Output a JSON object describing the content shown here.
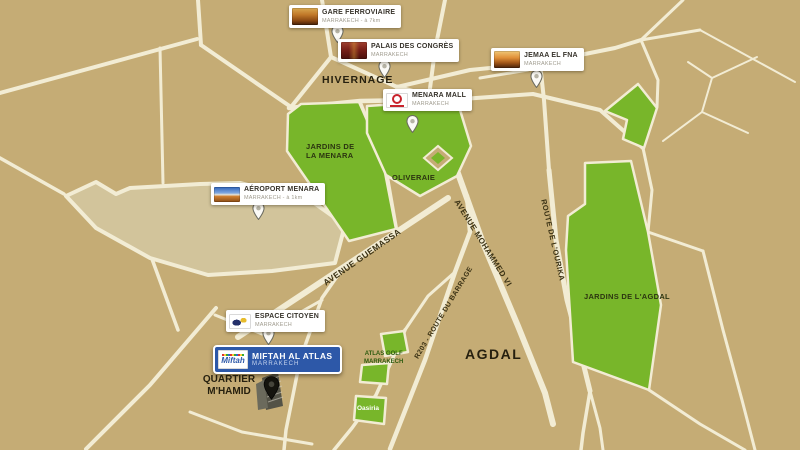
{
  "map": {
    "title": "Plan de situation Miftah Al Atlas - Marrakech",
    "markers": {
      "gare": {
        "title": "GARE FERROVIAIRE",
        "subtitle": "MARRAKECH - à 7km"
      },
      "palais": {
        "title": "PALAIS DES CONGRÈS",
        "subtitle": "MARRAKECH"
      },
      "jemaa": {
        "title": "JEMAA EL FNA",
        "subtitle": "MARRAKECH"
      },
      "menara_mall": {
        "title": "MENARA MALL",
        "subtitle": "MARRAKECH"
      },
      "aeroport": {
        "title": "AÉROPORT MENARA",
        "subtitle": "MARRAKECH - à 1km"
      },
      "espace": {
        "title": "ESPACE CITOYEN",
        "subtitle": "MARRAKECH"
      },
      "miftah": {
        "title": "MIFTAH AL ATLAS",
        "subtitle": "MARRAKECH",
        "logo_text": "Miftah"
      }
    },
    "region_labels": {
      "hivernage": "HIVERNAGE",
      "agdal": "AGDAL",
      "quartier_line1": "QUARTIER",
      "quartier_line2": "M'HAMID",
      "jardins_menara_line1": "JARDINS DE",
      "jardins_menara_line2": "LA MENARA",
      "oliveraie": "OLIVERAIE",
      "jardins_agdal": "JARDINS DE L'AGDAL",
      "atlas_golf_line1": "ATLAS GOLF",
      "atlas_golf_line2": "MARRAKECH",
      "oasiria": "Oasiria"
    },
    "road_labels": {
      "guemassa": "AVENUE GUEMASSA",
      "mohammed_vi": "AVENUE MOHAMMED VI",
      "barrage": "R203 - ROUTE DU BARRAGE",
      "ourika": "ROUTE DE L'OURIKA"
    },
    "colors": {
      "bg": "#c5ac75",
      "road": "#f2ecd4",
      "airport": "#d2c49b",
      "park": "#78b62a",
      "card_bg": "#ffffff",
      "card_title": "#37332b",
      "card_subtitle": "#a09c8f",
      "miftah_blue": "#2d58a8",
      "miftah_subtitle": "#c9d6ef",
      "label_dark": "#26200f",
      "road_label": "#3a3114",
      "park_label": "#2c3510",
      "green_text": "#2f5c10",
      "pin_fill": "#fbfaf6",
      "pin_stroke": "#6b6b60",
      "pin_dot": "#b7b4a6",
      "dark_pin": "#15140e"
    }
  }
}
